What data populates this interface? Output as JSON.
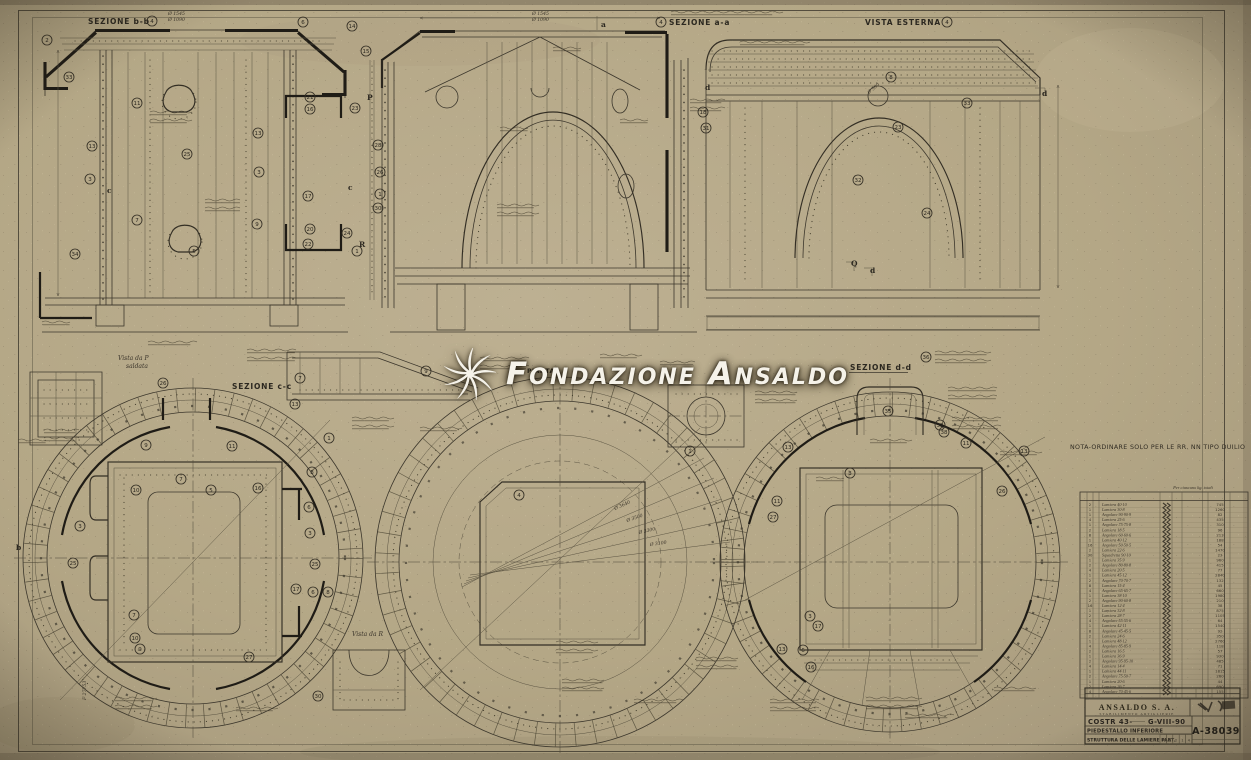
{
  "watermark": {
    "text": "Fondazione Ansaldo"
  },
  "labels": {
    "sez_bb": "SEZIONE b-b",
    "sez_aa": "SEZIONE a-a",
    "vista_esterna": "VISTA ESTERNA",
    "sez_cc": "SEZIONE c-c",
    "pianta": "PIANTA",
    "sez_dd": "SEZIONE d-d",
    "vista_p": "Vista da P",
    "vista_p_sub": "saldata",
    "vista_r": "Vista da R",
    "nota": "NOTA-ORDINARE SOLO PER LE RR. NN TIPO DUILIO"
  },
  "markers": [
    {
      "t": "a",
      "x": 601,
      "y": 27
    },
    {
      "t": "c",
      "x": 107,
      "y": 193
    },
    {
      "t": "c",
      "x": 348,
      "y": 190
    },
    {
      "t": "P",
      "x": 367,
      "y": 100
    },
    {
      "t": "R",
      "x": 359,
      "y": 247
    },
    {
      "t": "Q",
      "x": 851,
      "y": 266
    },
    {
      "t": "d",
      "x": 870,
      "y": 273
    },
    {
      "t": "d",
      "x": 1042,
      "y": 96
    },
    {
      "t": "d",
      "x": 705,
      "y": 90
    },
    {
      "t": "b",
      "x": 16,
      "y": 550
    },
    {
      "t": "F 27753",
      "x": 86,
      "y": 700,
      "r": -90
    }
  ],
  "callouts": [
    {
      "n": 4,
      "x": 152,
      "y": 21
    },
    {
      "n": 2,
      "x": 47,
      "y": 40
    },
    {
      "n": 6,
      "x": 303,
      "y": 22
    },
    {
      "n": 14,
      "x": 352,
      "y": 26
    },
    {
      "n": 33,
      "x": 69,
      "y": 77
    },
    {
      "n": 15,
      "x": 366,
      "y": 51
    },
    {
      "n": 11,
      "x": 137,
      "y": 103
    },
    {
      "n": 21,
      "x": 310,
      "y": 97
    },
    {
      "n": 16,
      "x": 310,
      "y": 109
    },
    {
      "n": 23,
      "x": 355,
      "y": 108
    },
    {
      "n": 13,
      "x": 92,
      "y": 146
    },
    {
      "n": 25,
      "x": 187,
      "y": 154
    },
    {
      "n": 13,
      "x": 258,
      "y": 133
    },
    {
      "n": 3,
      "x": 90,
      "y": 179
    },
    {
      "n": 3,
      "x": 259,
      "y": 172
    },
    {
      "n": 17,
      "x": 308,
      "y": 196
    },
    {
      "n": 7,
      "x": 137,
      "y": 220
    },
    {
      "n": 9,
      "x": 257,
      "y": 224
    },
    {
      "n": 5,
      "x": 194,
      "y": 251
    },
    {
      "n": 34,
      "x": 75,
      "y": 254
    },
    {
      "n": 20,
      "x": 310,
      "y": 229
    },
    {
      "n": 22,
      "x": 308,
      "y": 244
    },
    {
      "n": 24,
      "x": 347,
      "y": 233
    },
    {
      "n": 1,
      "x": 357,
      "y": 251
    },
    {
      "n": 28,
      "x": 378,
      "y": 145
    },
    {
      "n": 26,
      "x": 380,
      "y": 172
    },
    {
      "n": 1,
      "x": 380,
      "y": 194
    },
    {
      "n": 30,
      "x": 378,
      "y": 208
    },
    {
      "n": 4,
      "x": 661,
      "y": 22
    },
    {
      "n": 31,
      "x": 706,
      "y": 128
    },
    {
      "n": 18,
      "x": 703,
      "y": 112
    },
    {
      "n": 4,
      "x": 947,
      "y": 22
    },
    {
      "n": 8,
      "x": 891,
      "y": 77
    },
    {
      "n": 33,
      "x": 967,
      "y": 103
    },
    {
      "n": 23,
      "x": 898,
      "y": 127
    },
    {
      "n": 32,
      "x": 858,
      "y": 180
    },
    {
      "n": 24,
      "x": 927,
      "y": 213
    },
    {
      "n": 7,
      "x": 300,
      "y": 378
    },
    {
      "n": 9,
      "x": 426,
      "y": 371
    },
    {
      "n": 26,
      "x": 163,
      "y": 383
    },
    {
      "n": 36,
      "x": 926,
      "y": 357
    },
    {
      "n": 35,
      "x": 888,
      "y": 411
    },
    {
      "n": 38,
      "x": 944,
      "y": 432
    },
    {
      "n": 13,
      "x": 295,
      "y": 404
    },
    {
      "n": 9,
      "x": 146,
      "y": 445
    },
    {
      "n": 11,
      "x": 232,
      "y": 446
    },
    {
      "n": 7,
      "x": 181,
      "y": 479
    },
    {
      "n": 5,
      "x": 211,
      "y": 490
    },
    {
      "n": 10,
      "x": 136,
      "y": 490
    },
    {
      "n": 3,
      "x": 80,
      "y": 526
    },
    {
      "n": 25,
      "x": 73,
      "y": 563
    },
    {
      "n": 16,
      "x": 258,
      "y": 488
    },
    {
      "n": 8,
      "x": 312,
      "y": 472
    },
    {
      "n": 6,
      "x": 309,
      "y": 507
    },
    {
      "n": 3,
      "x": 310,
      "y": 533
    },
    {
      "n": 25,
      "x": 315,
      "y": 564
    },
    {
      "n": 17,
      "x": 296,
      "y": 589
    },
    {
      "n": 6,
      "x": 313,
      "y": 592
    },
    {
      "n": 8,
      "x": 328,
      "y": 592
    },
    {
      "n": 7,
      "x": 134,
      "y": 615
    },
    {
      "n": 10,
      "x": 135,
      "y": 638
    },
    {
      "n": 27,
      "x": 249,
      "y": 657
    },
    {
      "n": 9,
      "x": 140,
      "y": 649
    },
    {
      "n": 1,
      "x": 329,
      "y": 438
    },
    {
      "n": 4,
      "x": 519,
      "y": 495
    },
    {
      "n": 1,
      "x": 690,
      "y": 451
    },
    {
      "n": 32,
      "x": 940,
      "y": 425
    },
    {
      "n": 13,
      "x": 788,
      "y": 447
    },
    {
      "n": 13,
      "x": 1024,
      "y": 451
    },
    {
      "n": 11,
      "x": 966,
      "y": 443
    },
    {
      "n": 11,
      "x": 777,
      "y": 501
    },
    {
      "n": 27,
      "x": 773,
      "y": 517
    },
    {
      "n": 3,
      "x": 850,
      "y": 473
    },
    {
      "n": 26,
      "x": 1002,
      "y": 491
    },
    {
      "n": 3,
      "x": 810,
      "y": 616
    },
    {
      "n": 17,
      "x": 818,
      "y": 626
    },
    {
      "n": 13,
      "x": 782,
      "y": 649
    },
    {
      "n": 6,
      "x": 803,
      "y": 650
    },
    {
      "n": 16,
      "x": 811,
      "y": 667
    },
    {
      "n": 30,
      "x": 318,
      "y": 696
    }
  ],
  "dims": [
    {
      "t": "Ø 1545",
      "x": 168,
      "y": 15
    },
    {
      "t": "Ø 1090",
      "x": 168,
      "y": 21
    },
    {
      "t": "Ø 1545",
      "x": 532,
      "y": 15
    },
    {
      "t": "Ø 1090",
      "x": 532,
      "y": 21
    },
    {
      "t": "Ø 3640",
      "x": 615,
      "y": 510,
      "r": -24
    },
    {
      "t": "Ø 3500",
      "x": 627,
      "y": 522,
      "r": -19
    },
    {
      "t": "Ø 3300",
      "x": 639,
      "y": 534,
      "r": -13
    },
    {
      "t": "Ø 3100",
      "x": 650,
      "y": 546,
      "r": -8
    },
    {
      "t": "Ø 500",
      "x": 869,
      "y": 94,
      "r": -40
    }
  ],
  "table": {
    "header": "Per ciascuno kg. totali",
    "rows": [
      {
        "q": 2,
        "d": "Lamiera 40·10",
        "w": 745
      },
      {
        "q": 1,
        "d": "Lamiera 30·8",
        "w": 1260
      },
      {
        "q": 1,
        "d": "Angolare 90·90·9",
        "w": 82
      },
      {
        "q": 4,
        "d": "Lamiera 25·6",
        "w": 435
      },
      {
        "q": 1,
        "d": "Angolare 75·75·8",
        "w": 310
      },
      {
        "q": 2,
        "d": "Lamiera 18·5",
        "w": 96
      },
      {
        "q": 8,
        "d": "Angolare 60·60·6",
        "w": 213
      },
      {
        "q": 1,
        "d": "Lamiera 40·12",
        "w": 188
      },
      {
        "q": 16,
        "d": "Angolare 50·50·5",
        "w": 54
      },
      {
        "q": 2,
        "d": "Lamiera 22·6",
        "w": 1470
      },
      {
        "q": 30,
        "d": "Squadretta 90·10",
        "w": 23
      },
      {
        "q": 1,
        "d": "Lamiera 35·9",
        "w": 960
      },
      {
        "q": 2,
        "d": "Angolare 80·80·8",
        "w": 415
      },
      {
        "q": 4,
        "d": "Lamiera 20·5",
        "w": 77
      },
      {
        "q": 1,
        "d": "Lamiera 45·12",
        "w": 2840
      },
      {
        "q": 2,
        "d": "Angolare 70·70·7",
        "w": 132
      },
      {
        "q": 8,
        "d": "Lamiera 15·4",
        "w": 45
      },
      {
        "q": 4,
        "d": "Angolare 65·65·7",
        "w": 660
      },
      {
        "q": 1,
        "d": "Lamiera 38·10",
        "w": 1980
      },
      {
        "q": 2,
        "d": "Angolare 90·60·8",
        "w": 210
      },
      {
        "q": 16,
        "d": "Lamiera 12·4",
        "w": 38
      },
      {
        "q": 1,
        "d": "Lamiera 32·8",
        "w": 875
      },
      {
        "q": 2,
        "d": "Lamiera 28·7",
        "w": 1105
      },
      {
        "q": 4,
        "d": "Angolare 55·55·6",
        "w": 64
      },
      {
        "q": 1,
        "d": "Lamiera 42·11",
        "w": 1540
      },
      {
        "q": 8,
        "d": "Angolare 45·45·5",
        "w": 92
      },
      {
        "q": 2,
        "d": "Lamiera 24·6",
        "w": 350
      },
      {
        "q": 1,
        "d": "Lamiera 48·12",
        "w": 2760
      },
      {
        "q": 4,
        "d": "Angolare 85·85·9",
        "w": 118
      },
      {
        "q": 2,
        "d": "Lamiera 16·5",
        "w": 57
      },
      {
        "q": 1,
        "d": "Lamiera 36·9",
        "w": 930
      },
      {
        "q": 2,
        "d": "Angolare 95·95·10",
        "w": 485
      },
      {
        "q": 4,
        "d": "Lamiera 14·4",
        "w": 71
      },
      {
        "q": 1,
        "d": "Lamiera 44·11",
        "w": 1815
      },
      {
        "q": 2,
        "d": "Angolare 75·50·7",
        "w": 260
      },
      {
        "q": 1,
        "d": "Lamiera 20·6",
        "w": 44
      },
      {
        "q": 2,
        "d": "Lamiera 26·7",
        "w": 690
      },
      {
        "q": 4,
        "d": "Angolare 70·45·6",
        "w": 155
      }
    ]
  },
  "title_block": {
    "company": "ANSALDO S. A.",
    "department": "STABILIMENTO ARTIGLIERIE",
    "costr": "COSTR 43-",
    "ref": "G-VIII-90",
    "subject1": "PIEDESTALLO INFERIORE",
    "subject2": "STRUTTURA DELLE LAMIERE PART.",
    "drawing_number": "A-38039",
    "rev_cells": [
      "F",
      "1",
      "2",
      "1",
      "4"
    ]
  }
}
